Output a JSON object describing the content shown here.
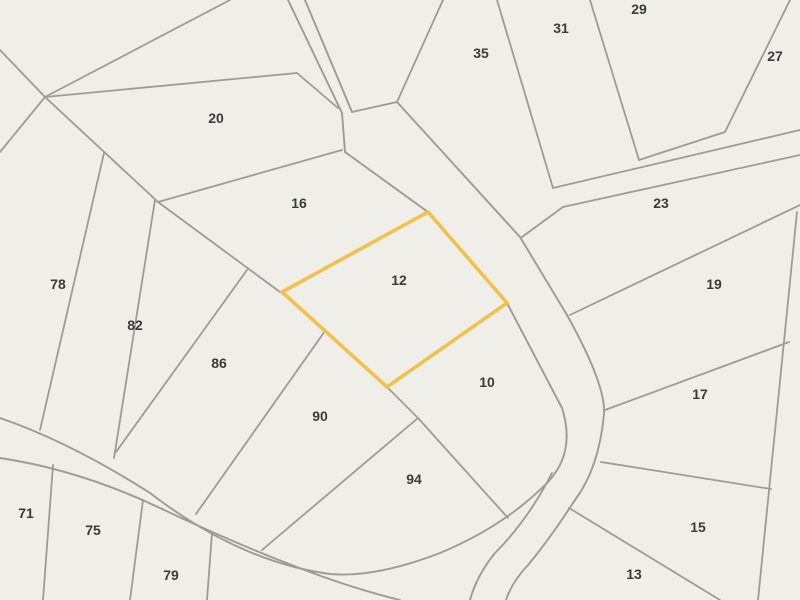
{
  "map": {
    "type": "cadastral-parcel-map",
    "selected_parcel": "12",
    "colors": {
      "background": "#f0eee8",
      "boundary_line": "#9c9b95",
      "highlight": "#f2c14b",
      "label_text": "#3b3b3b"
    },
    "parcels": [
      {
        "number": "20"
      },
      {
        "number": "35"
      },
      {
        "number": "31"
      },
      {
        "number": "29"
      },
      {
        "number": "27"
      },
      {
        "number": "16"
      },
      {
        "number": "23"
      },
      {
        "number": "12"
      },
      {
        "number": "19"
      },
      {
        "number": "78"
      },
      {
        "number": "82"
      },
      {
        "number": "86"
      },
      {
        "number": "90"
      },
      {
        "number": "10"
      },
      {
        "number": "17"
      },
      {
        "number": "94"
      },
      {
        "number": "15"
      },
      {
        "number": "13"
      },
      {
        "number": "71"
      },
      {
        "number": "75"
      },
      {
        "number": "79"
      }
    ]
  }
}
